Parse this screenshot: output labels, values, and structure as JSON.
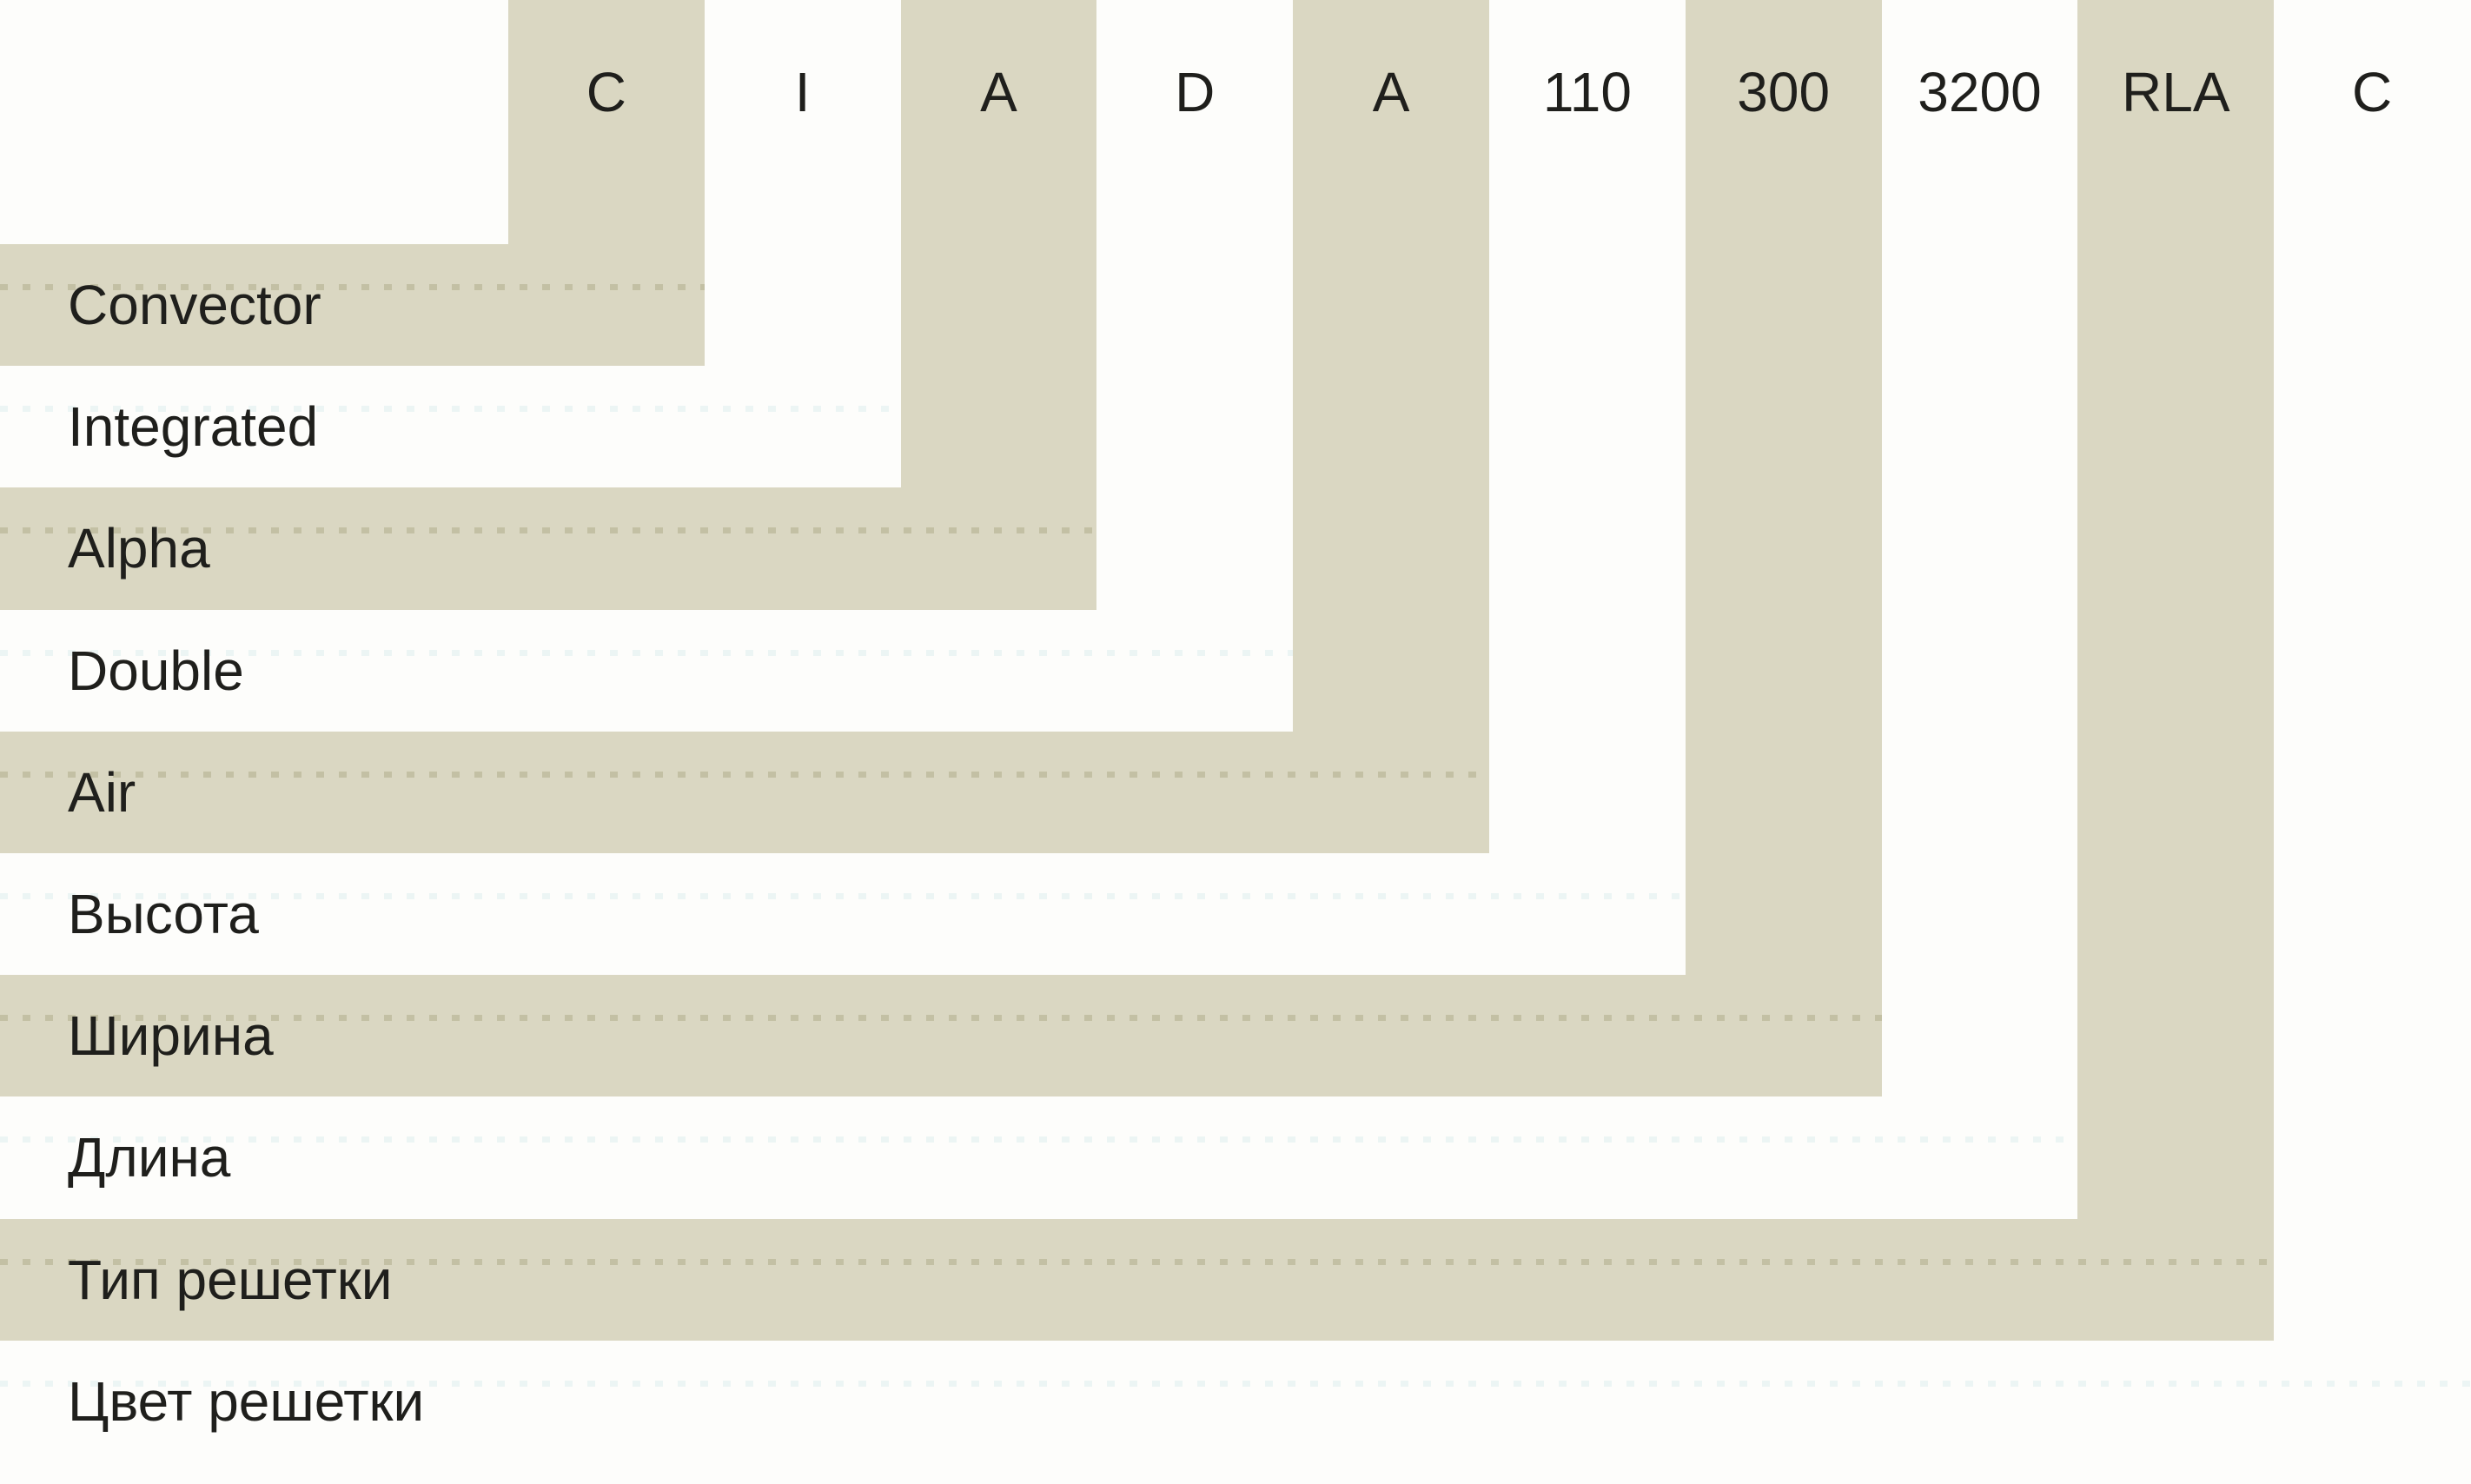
{
  "diagram": {
    "segments": [
      {
        "code": "C",
        "label": "Convector"
      },
      {
        "code": "I",
        "label": "Integrated"
      },
      {
        "code": "A",
        "label": "Alpha"
      },
      {
        "code": "D",
        "label": "Double"
      },
      {
        "code": "A",
        "label": "Air"
      },
      {
        "code": "110",
        "label": "Высота"
      },
      {
        "code": "300",
        "label": "Ширина"
      },
      {
        "code": "3200",
        "label": "Длина"
      },
      {
        "code": "RLA",
        "label": "Тип решетки"
      },
      {
        "code": "C",
        "label": "Цвет решетки"
      }
    ]
  },
  "colors": {
    "band_beige": "#dad7c2",
    "background": "#fdfdfb",
    "text": "#1f1f1c"
  }
}
